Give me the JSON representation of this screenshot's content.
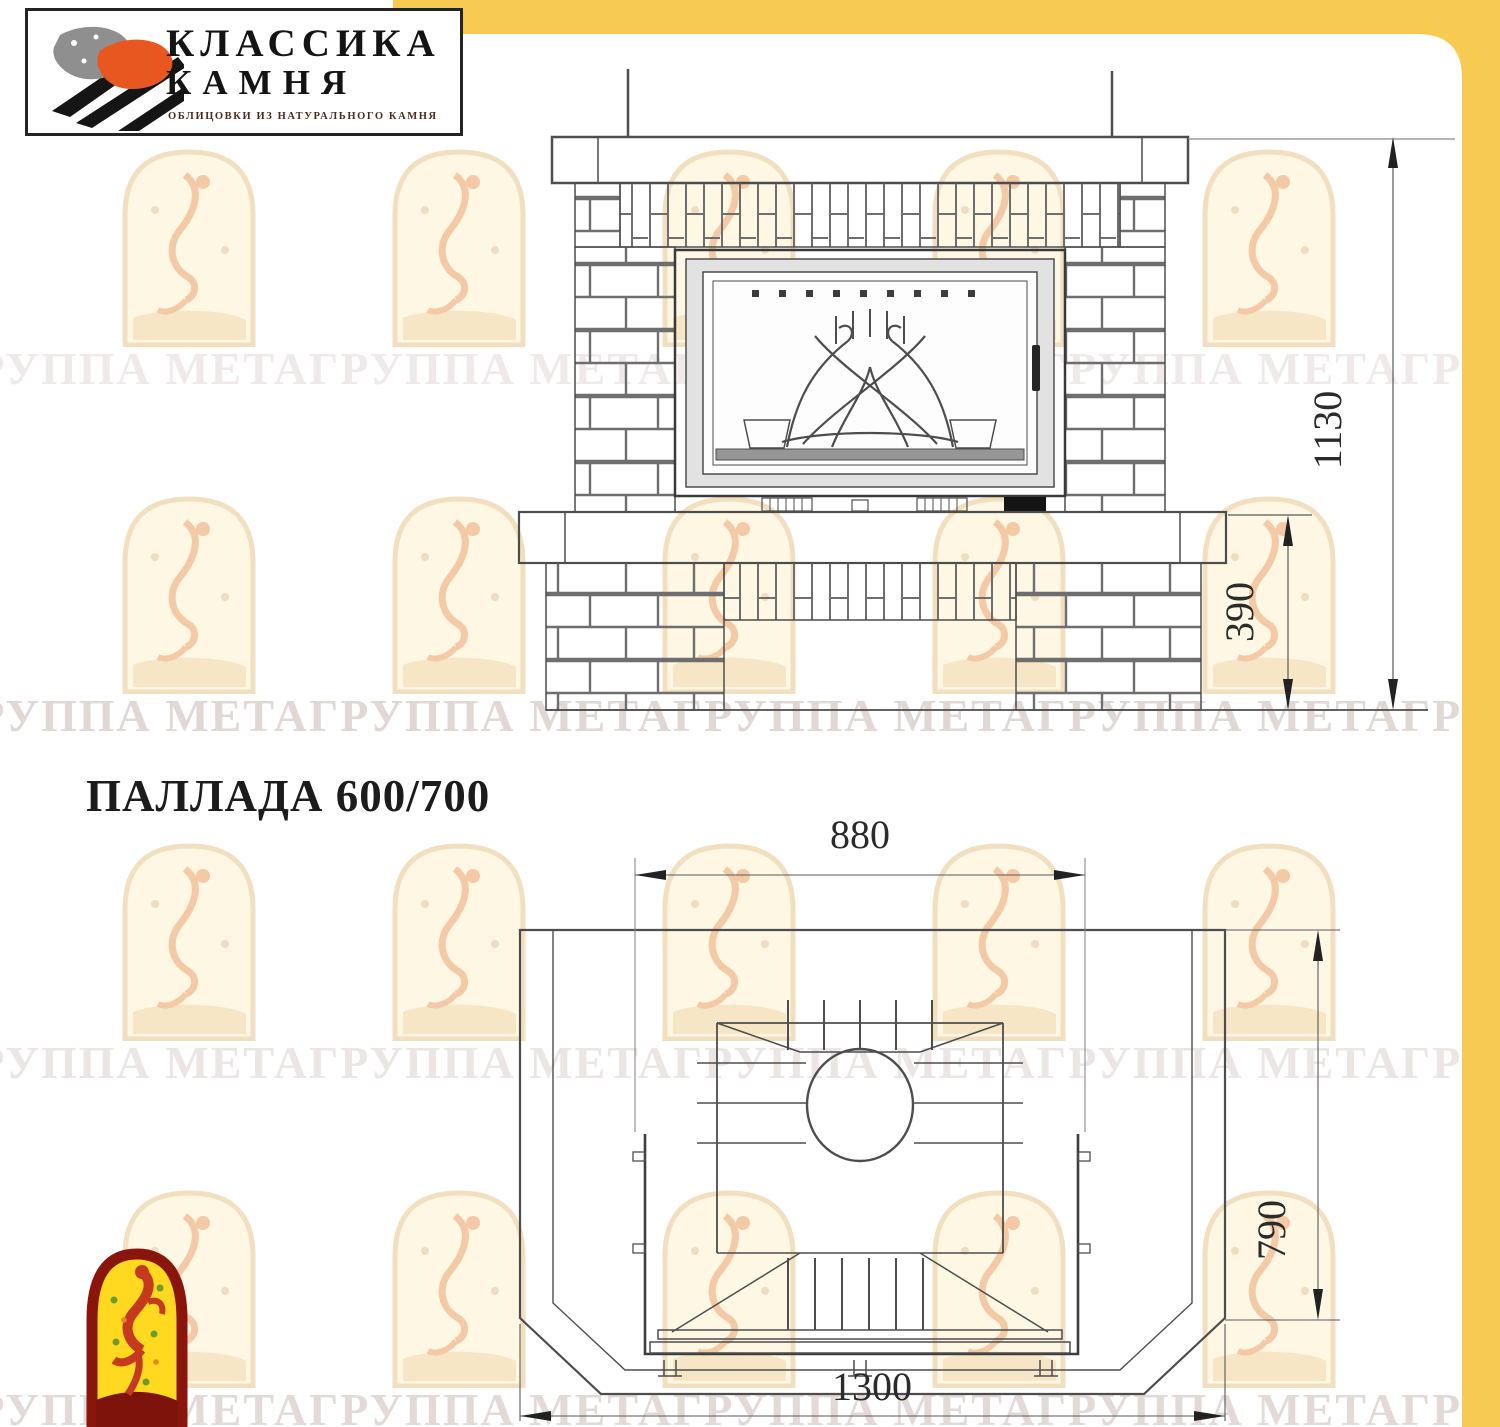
{
  "page": {
    "title": "ПАЛЛАДА 600/700",
    "frame_color": "#f7ca52",
    "background": "#ffffff"
  },
  "logo": {
    "line1": "КЛАССИКА",
    "line2": "КАМНЯ",
    "subtitle": "ОБЛИЦОВКИ ИЗ НАТУРАЛЬНОГО КАМНЯ",
    "mark_colors": {
      "stone_gray": "#8f8f8f",
      "stone_orange": "#e8571f",
      "strokes": "#151515"
    }
  },
  "watermark": {
    "text": "ГРУППА МЕТАГРУППА МЕТАГРУППА МЕТАГРУППА МЕТАГРУППА МЕТАГРУППА МЕТА"
  },
  "drawing": {
    "dimensions": {
      "height_total": "1130",
      "base_height": "390",
      "top_width": "880",
      "depth": "790",
      "bottom_width": "1300"
    }
  }
}
